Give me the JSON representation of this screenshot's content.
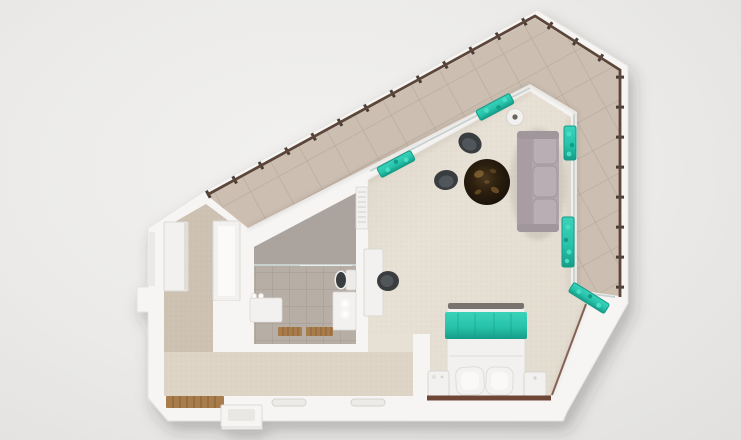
{
  "scene": {
    "type": "3d-floor-plan-top-view",
    "rooms": [
      {
        "name": "balcony-terrace"
      },
      {
        "name": "living-room"
      },
      {
        "name": "bedroom-area"
      },
      {
        "name": "bathroom"
      },
      {
        "name": "hallway-wardrobe-room"
      },
      {
        "name": "corridor"
      }
    ],
    "objects": [
      "railing",
      "window-planter",
      "sofa",
      "armchair",
      "round-rug",
      "floor-lamp",
      "desk",
      "desk-chair",
      "radiator",
      "double-bed",
      "teal-bed-runner",
      "pillow",
      "nightstand",
      "wardrobe",
      "shower",
      "shower-glass",
      "toilet",
      "vanity-sink",
      "bath-bench",
      "wooden-bath-mat",
      "entrance-doormat",
      "door-step",
      "threshold"
    ]
  },
  "colors": {
    "background": "#eeedeb",
    "wall": "#f6f5f3",
    "wall_edge": "#dbd8d4",
    "balcony_tile": "#ccbfb2",
    "balcony_grout": "#b7a99c",
    "railing": "#5c4639",
    "railing_post": "#3a2d25",
    "carpet_living": "#e7e0d4",
    "carpet_hall": "#cdc1b1",
    "carpet_corridor": "#ded4c6",
    "bath_tile": "#b7aea6",
    "shower_tile": "#a9a19b",
    "tile_line": "#a49b93",
    "glass": "#c8d1cf",
    "teal": "#27c3ab",
    "teal_dark": "#149a85",
    "teal_light": "#4adcc5",
    "sofa": "#b1a6ac",
    "sofa_cushion": "#b9aeb4",
    "sofa_trim": "#a2969d",
    "chair_dark": "#3a3d40",
    "chair_seat": "#51565b",
    "rug_base": "#211708",
    "rug_gold": "#8d6a35",
    "white_furniture": "#f2f1ef",
    "furniture_line": "#d9d6d2",
    "wood": "#a97c4b",
    "wood_dark": "#8a6239",
    "baseboard": "#6e4636",
    "bed_foot_rail": "#7a736d"
  }
}
